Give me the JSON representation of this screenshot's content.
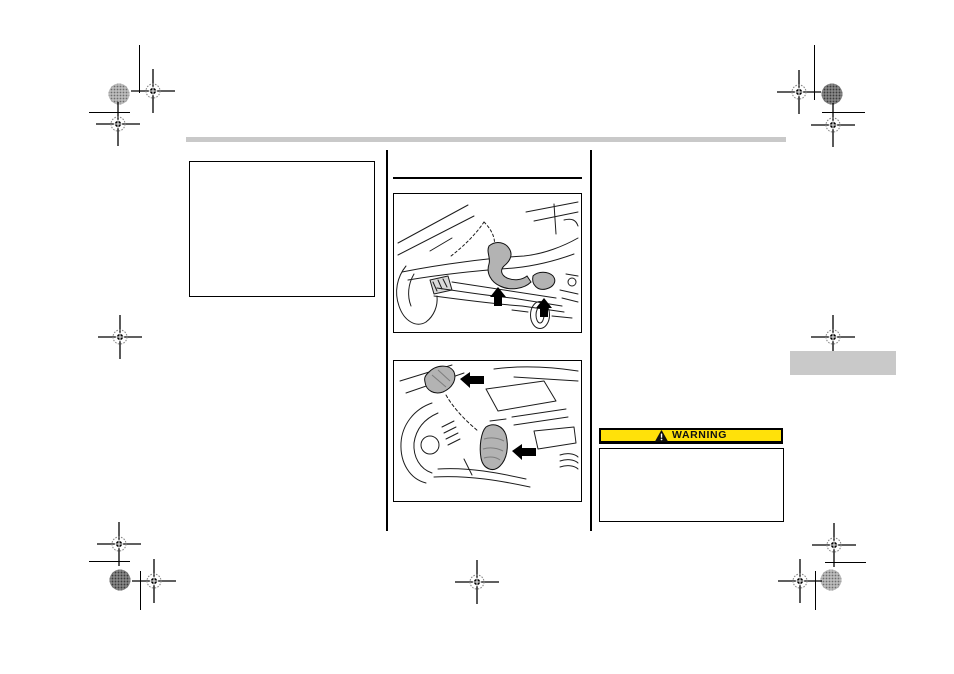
{
  "warning": {
    "label": "WARNING",
    "banner_color": "#FFE10A",
    "text_color": "#111111",
    "icon": "warning-triangle-icon"
  },
  "colors": {
    "header_bar_gray": "#C9C9C9",
    "side_tab_gray": "#C9C9C9",
    "figure_hook_gray": "#B3B3B3",
    "line_black": "#000000"
  },
  "icons": {
    "warning_triangle": "black triangle with white exclamation mark",
    "up_arrow": "solid black arrow pointing up",
    "left_arrow": "solid black arrow pointing left",
    "registration_crosshair": "print registration target mark",
    "halftone_dot": "round ink density patch"
  }
}
